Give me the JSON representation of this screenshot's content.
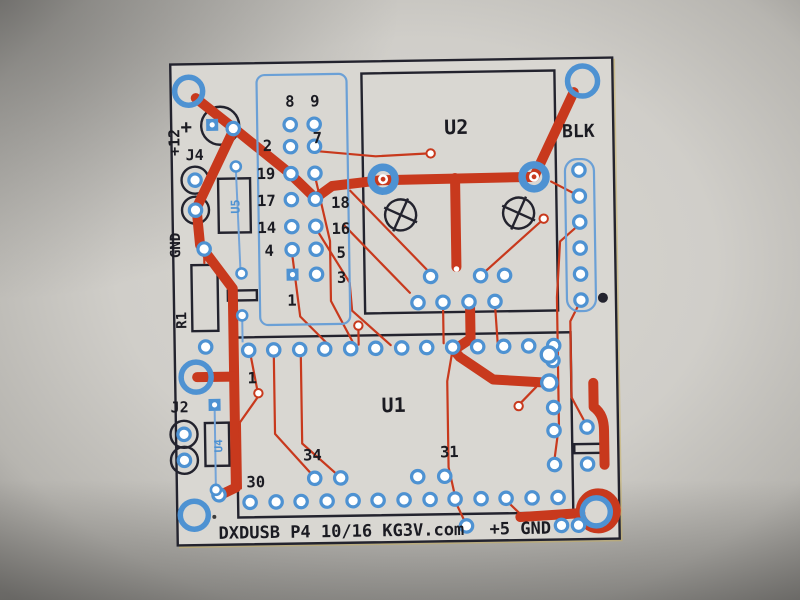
{
  "board": {
    "silkscreen_title": "DXDUSB P4 10/16 KG3V.com",
    "power_labels": {
      "plus": "+",
      "plus12": "+12",
      "gnd_left": "GND",
      "plus5_gnd": "+5 GND"
    },
    "components": {
      "u1": "U1",
      "u2": "U2",
      "u4": "U4",
      "u5": "U5",
      "j2": "J2",
      "j4": "J4",
      "r1": "R1"
    },
    "connector_label": "BLK",
    "header_pins": {
      "p8": "8",
      "p9": "9",
      "p2": "2",
      "p7": "7",
      "p19": "19",
      "p17": "17",
      "p18": "18",
      "p14": "14",
      "p16": "16",
      "p4": "4",
      "p5": "5",
      "p3": "3",
      "p1": "1"
    },
    "u1_pins": {
      "p1": "1",
      "p34": "34",
      "p31": "31",
      "p30": "30"
    },
    "colors": {
      "trace_red": "#c8391d",
      "pad_blue": "#4e92d2",
      "wire_blue": "#74a4d8",
      "outline_black": "#23232e",
      "paper": "#d8d6d1",
      "text_black": "#1b1b22"
    }
  }
}
